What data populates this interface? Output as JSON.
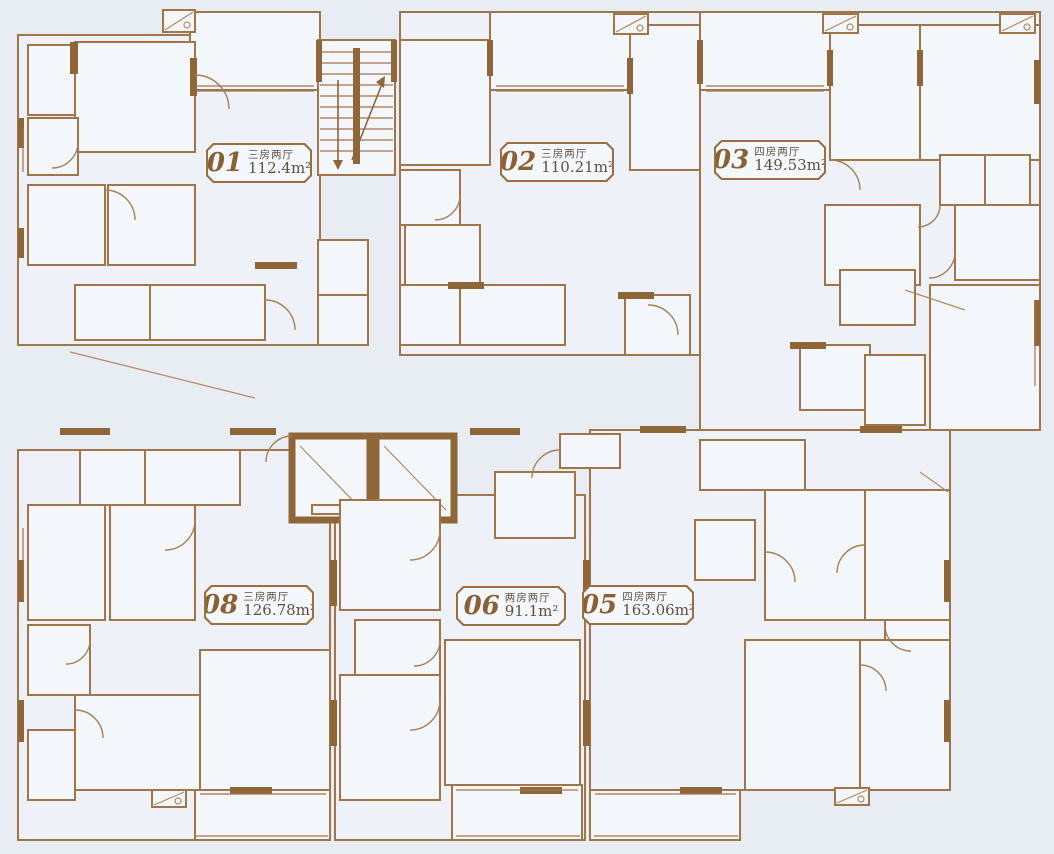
{
  "title": "residential-floor-plan",
  "colors": {
    "background": "#e8edf4",
    "wall": "#a1754a",
    "wall_dark": "#8f6637",
    "label_text": "#6f5335",
    "badge_number": "#8a6134"
  },
  "units": [
    {
      "id": "01",
      "type": "三房两厅",
      "area": "112.4",
      "area_unit": "m²",
      "x": 206,
      "y": 143,
      "w": 102
    },
    {
      "id": "02",
      "type": "三房两厅",
      "area": "110.21",
      "area_unit": "m²",
      "x": 500,
      "y": 142,
      "w": 110
    },
    {
      "id": "03",
      "type": "四房两厅",
      "area": "149.53",
      "area_unit": "m²",
      "x": 714,
      "y": 140,
      "w": 108
    },
    {
      "id": "08",
      "type": "三房两厅",
      "area": "126.78",
      "area_unit": "m²",
      "x": 204,
      "y": 585,
      "w": 106
    },
    {
      "id": "06",
      "type": "两房两厅",
      "area": "91.1",
      "area_unit": "m²",
      "x": 456,
      "y": 586,
      "w": 106
    },
    {
      "id": "05",
      "type": "四房两厅",
      "area": "163.06",
      "area_unit": "m²",
      "x": 582,
      "y": 585,
      "w": 108
    }
  ],
  "labels": [
    {
      "text": "阳台",
      "x": 256,
      "y": 34
    },
    {
      "text": "主卫",
      "x": 57,
      "y": 80,
      "cls": "s"
    },
    {
      "text": "主卧",
      "x": 140,
      "y": 105
    },
    {
      "text": "客厅",
      "x": 258,
      "y": 112
    },
    {
      "text": "卫生间",
      "x": 52,
      "y": 147,
      "cls": "s"
    },
    {
      "text": "卧室",
      "x": 66,
      "y": 222
    },
    {
      "text": "卧室",
      "x": 152,
      "y": 222
    },
    {
      "text": "餐厅",
      "x": 243,
      "y": 222
    },
    {
      "text": "生活阳台",
      "x": 112,
      "y": 313,
      "cls": "s"
    },
    {
      "text": "厨房",
      "x": 187,
      "y": 310
    },
    {
      "text": "水井",
      "x": 342,
      "y": 268,
      "cls": "s"
    },
    {
      "text": "电井",
      "x": 342,
      "y": 320,
      "cls": "s"
    },
    {
      "text": "下",
      "x": 336,
      "y": 188,
      "cls": "stair"
    },
    {
      "text": "上",
      "x": 377,
      "y": 188,
      "cls": "stair"
    },
    {
      "text": "主卧",
      "x": 443,
      "y": 103
    },
    {
      "text": "阳台",
      "x": 556,
      "y": 37
    },
    {
      "text": "客厅",
      "x": 551,
      "y": 103
    },
    {
      "text": "卧室",
      "x": 656,
      "y": 120
    },
    {
      "text": "主卫",
      "x": 428,
      "y": 198,
      "cls": "s"
    },
    {
      "text": "餐厅",
      "x": 530,
      "y": 229
    },
    {
      "text": "卫生间",
      "x": 443,
      "y": 251,
      "cls": "s"
    },
    {
      "text": "内天井",
      "x": 429,
      "y": 312,
      "cls": "s"
    },
    {
      "text": "厨房",
      "x": 505,
      "y": 316
    },
    {
      "text": "内天井",
      "x": 657,
      "y": 326,
      "cls": "s"
    },
    {
      "text": "阳台",
      "x": 766,
      "y": 35
    },
    {
      "text": "客厅",
      "x": 764,
      "y": 112
    },
    {
      "text": "卧室",
      "x": 872,
      "y": 99
    },
    {
      "text": "主卧",
      "x": 971,
      "y": 99
    },
    {
      "text": "衣帽间",
      "x": 962,
      "y": 179,
      "cls": "xs"
    },
    {
      "text": "衣帽间",
      "x": 1007,
      "y": 179,
      "cls": "xs"
    },
    {
      "text": "餐厅",
      "x": 774,
      "y": 240
    },
    {
      "text": "书房",
      "x": 872,
      "y": 246
    },
    {
      "text": "主卫",
      "x": 1001,
      "y": 243,
      "cls": "s"
    },
    {
      "text": "卫生间",
      "x": 874,
      "y": 297,
      "cls": "s"
    },
    {
      "text": "厨房",
      "x": 833,
      "y": 376
    },
    {
      "text": "生活阳台",
      "x": 893,
      "y": 390,
      "cls": "s"
    },
    {
      "text": "卧室",
      "x": 970,
      "y": 357
    },
    {
      "text": "燃气井",
      "x": 600,
      "y": 448,
      "cls": "s"
    },
    {
      "text": "消防 梯",
      "x": 414,
      "y": 480,
      "cls": "fire"
    },
    {
      "text": "生活阳台",
      "x": 742,
      "y": 465,
      "cls": "s"
    },
    {
      "text": "厨房",
      "x": 536,
      "y": 507
    },
    {
      "text": "餐厅",
      "x": 655,
      "y": 536
    },
    {
      "text": "厨房",
      "x": 723,
      "y": 549
    },
    {
      "text": "卧室",
      "x": 805,
      "y": 550
    },
    {
      "text": "卧室",
      "x": 897,
      "y": 550
    },
    {
      "text": "主卫",
      "x": 920,
      "y": 645,
      "cls": "s"
    },
    {
      "text": "生活阳台",
      "x": 113,
      "y": 476,
      "cls": "s"
    },
    {
      "text": "厨房",
      "x": 190,
      "y": 476
    },
    {
      "text": "卧室",
      "x": 67,
      "y": 563
    },
    {
      "text": "卧室",
      "x": 154,
      "y": 563
    },
    {
      "text": "餐厅",
      "x": 224,
      "y": 572
    },
    {
      "text": "卫生间",
      "x": 57,
      "y": 661,
      "cls": "s"
    },
    {
      "text": "主卧",
      "x": 136,
      "y": 728
    },
    {
      "text": "主卫",
      "x": 55,
      "y": 765,
      "cls": "s"
    },
    {
      "text": "客厅",
      "x": 250,
      "y": 722
    },
    {
      "text": "阳台",
      "x": 250,
      "y": 808
    },
    {
      "text": "卧室",
      "x": 390,
      "y": 551
    },
    {
      "text": "卫生间",
      "x": 393,
      "y": 648,
      "cls": "s"
    },
    {
      "text": "卧室",
      "x": 397,
      "y": 740
    },
    {
      "text": "客厅",
      "x": 506,
      "y": 723
    },
    {
      "text": "阳台",
      "x": 508,
      "y": 810
    },
    {
      "text": "客厅",
      "x": 637,
      "y": 723
    },
    {
      "text": "卧室",
      "x": 798,
      "y": 730
    },
    {
      "text": "主卧",
      "x": 899,
      "y": 737
    },
    {
      "text": "阳台",
      "x": 638,
      "y": 810
    }
  ]
}
